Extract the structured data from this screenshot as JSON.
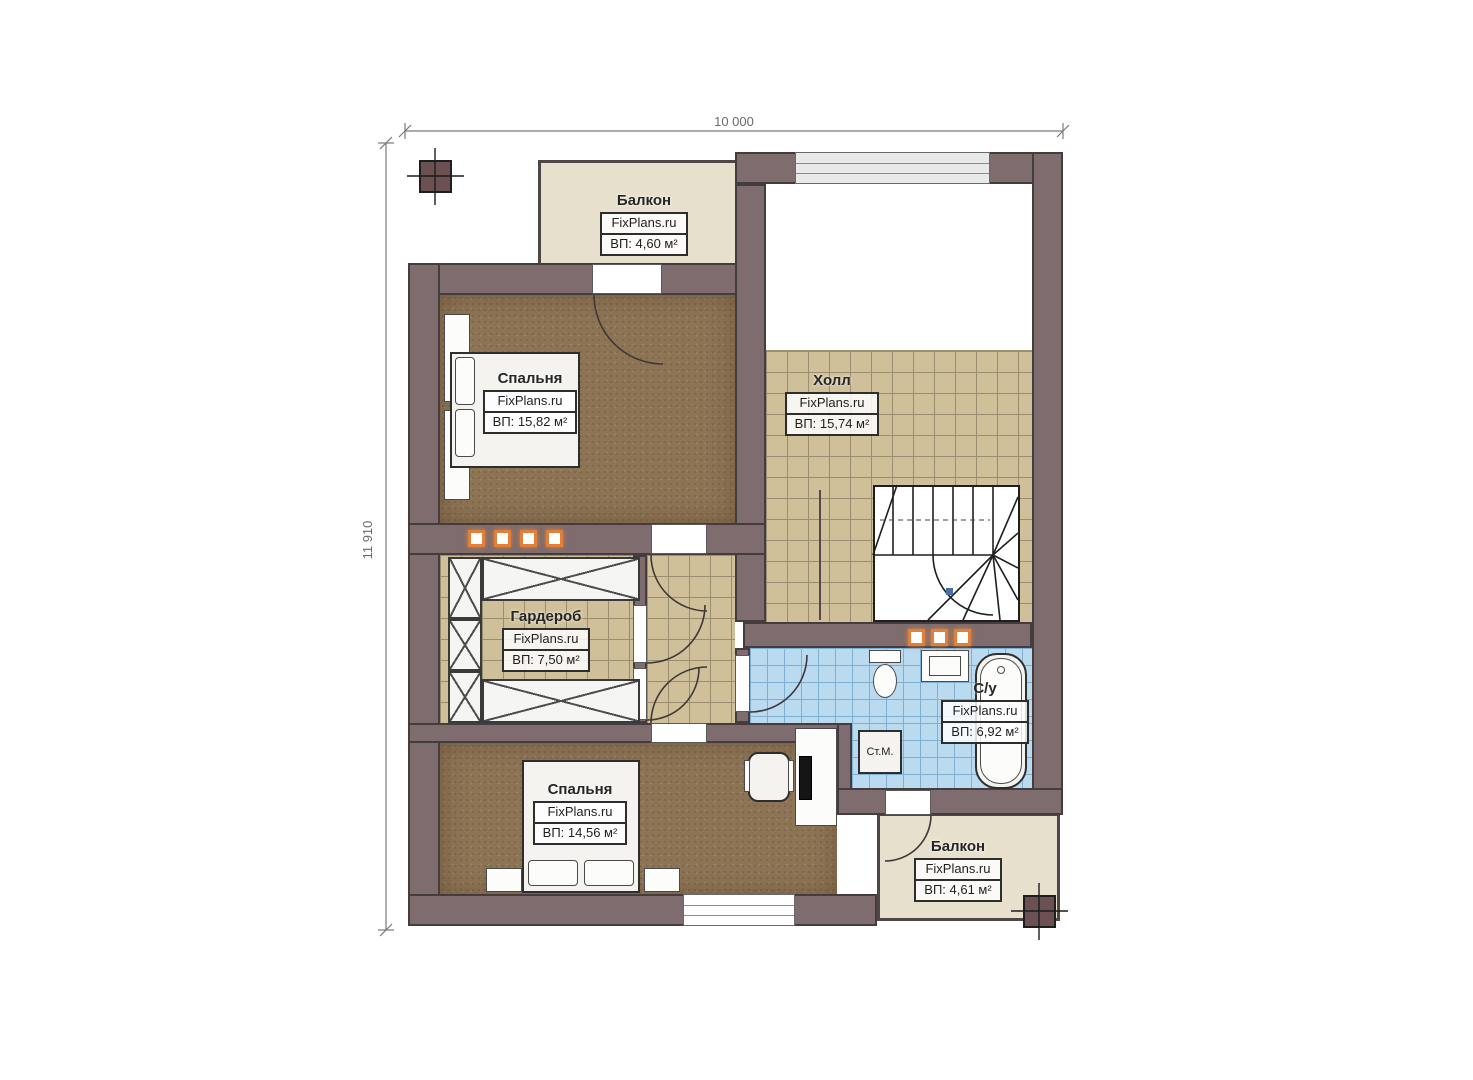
{
  "plan": {
    "watermark": "FixPlans.ru",
    "dimensions": {
      "width_label": "10 000",
      "height_label": "11 910"
    },
    "rooms": {
      "balcony_top": {
        "name": "Балкон",
        "area": "ВП: 4,60 м²"
      },
      "bedroom_top": {
        "name": "Спальня",
        "area": "ВП: 15,82 м²"
      },
      "hall": {
        "name": "Холл",
        "area": "ВП: 15,74 м²"
      },
      "wardrobe": {
        "name": "Гардероб",
        "area": "ВП: 7,50 м²"
      },
      "bathroom": {
        "name": "С/у",
        "area": "ВП: 6,92 м²"
      },
      "bedroom_bottom": {
        "name": "Спальня",
        "area": "ВП: 14,56 м²"
      },
      "balcony_bottom": {
        "name": "Балкон",
        "area": "ВП: 4,61 м²"
      }
    },
    "appliances": {
      "washing_machine": "Ст.М."
    },
    "colors": {
      "wall": "#7e6c6e",
      "bedroom_floor": "#8d7455",
      "hall_tile": "#cfc099",
      "bathroom_tile": "#badaf0",
      "balcony_floor": "#e7e0cd",
      "accent_orange": "#e2803a"
    }
  }
}
